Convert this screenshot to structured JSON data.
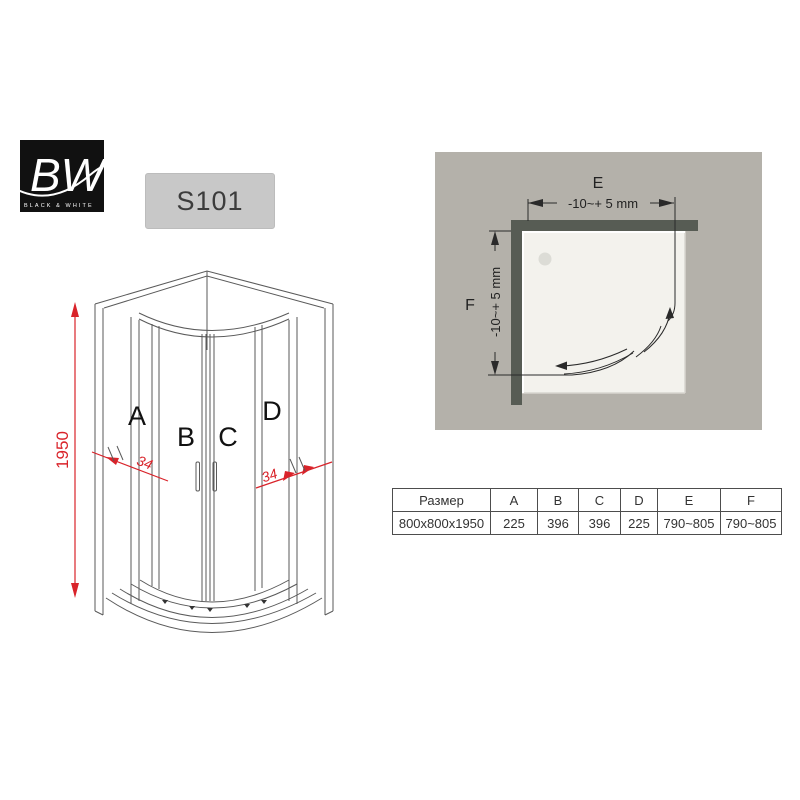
{
  "brand": {
    "initials": "BW",
    "name": "BLACK & WHITE"
  },
  "model": {
    "code": "S101"
  },
  "front_view": {
    "height_mm": "1950",
    "profile_width_left": "34",
    "profile_width_right": "34",
    "panel_labels": {
      "a": "A",
      "b": "B",
      "c": "C",
      "d": "D"
    }
  },
  "top_view": {
    "width_label": "E",
    "depth_label": "F",
    "width_tolerance": "-10~+ 5 mm",
    "depth_tolerance": "-10~+ 5 mm"
  },
  "spec_table": {
    "headers": [
      "Размер",
      "A",
      "B",
      "C",
      "D",
      "E",
      "F"
    ],
    "row": [
      "800x800x1950",
      "225",
      "396",
      "396",
      "225",
      "790~805",
      "790~805"
    ]
  },
  "colors": {
    "dimension_red": "#d9232a",
    "panel_gray": "#b4b1aa",
    "wall_gray": "#575c54",
    "tray_white": "#f3f2ed",
    "logo_black": "#111111",
    "model_box_gray": "#c8c8c8"
  }
}
